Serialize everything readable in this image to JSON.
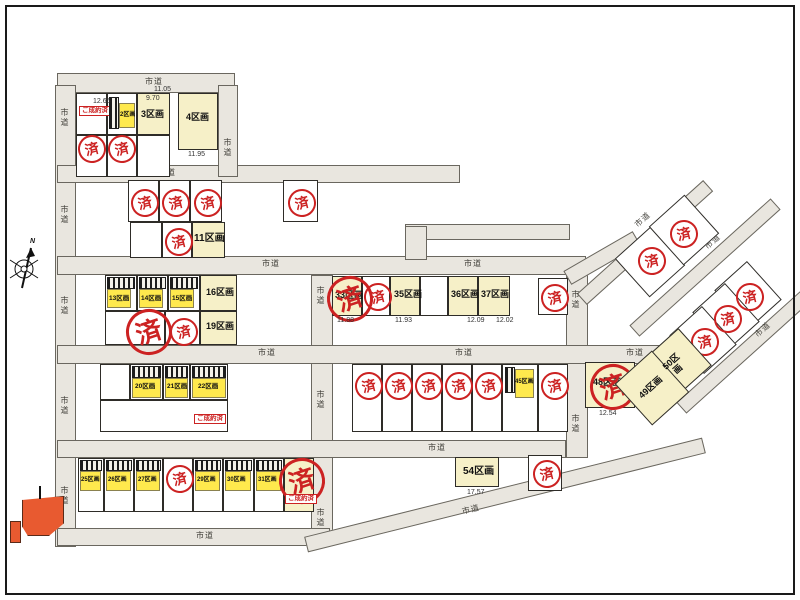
{
  "map": {
    "road_label": "市道",
    "stamp_char": "済",
    "sold_label": "ご成約済",
    "compass_n": "N",
    "lots": {
      "2": "2区画",
      "3": "3区画",
      "4": "4区画",
      "11": "11区画",
      "13": "13区画",
      "14": "14区画",
      "15": "15区画",
      "16": "16区画",
      "19": "19区画",
      "20": "20区画",
      "21": "21区画",
      "22": "22区画",
      "25": "25区画",
      "26": "26区画",
      "27": "27区画",
      "29": "29区画",
      "30": "30区画",
      "31": "31区画",
      "33": "33区画",
      "35": "35区画",
      "36": "36区画",
      "37": "37区画",
      "45": "45区画",
      "48": "48区画",
      "49": "49区画",
      "50": "50区画",
      "54": "54区画"
    },
    "dims": {
      "d1": "12.65",
      "d2": "9.70",
      "d3": "11.05",
      "d4": "11.95",
      "d5": "11.88",
      "d6": "11.93",
      "d7": "12.09",
      "d8": "12.02",
      "d9": "12.54",
      "d10": "17.57"
    },
    "colors": {
      "road": "#e9e6df",
      "lot_available": "#f6f0c8",
      "house": "#ffe94d",
      "stamp_red": "#cc2222",
      "reserve_orange": "#e85a30"
    }
  }
}
